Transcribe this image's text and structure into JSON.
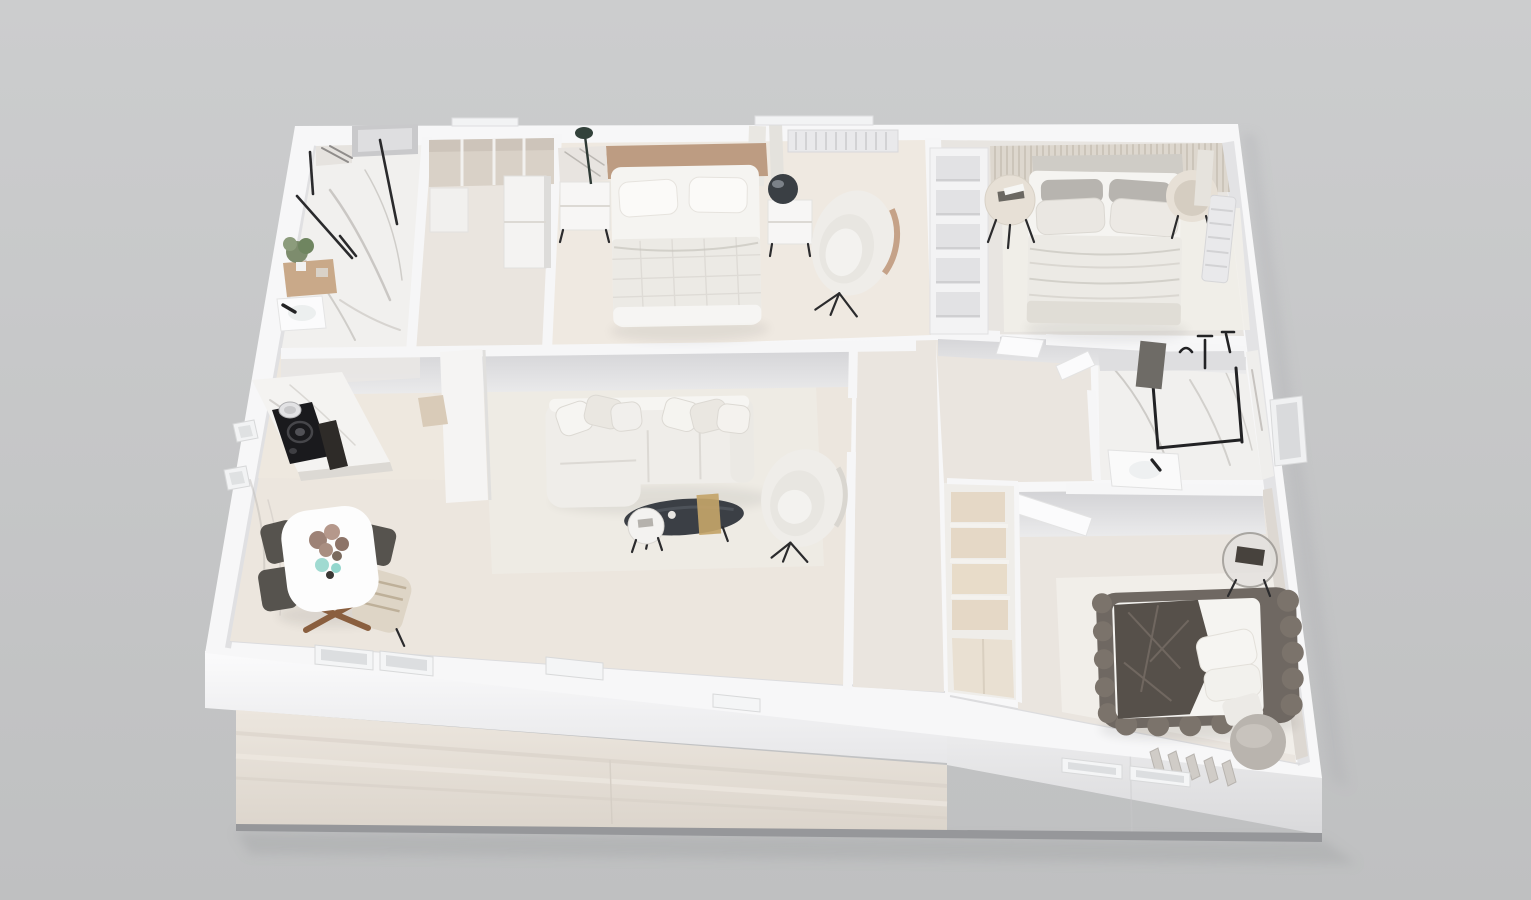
{
  "scene": {
    "type": "3d-floor-plan-render",
    "view": "axonometric top-down cutaway of a furnished apartment",
    "background": "#c7c8c9",
    "text_content": "none (image contains no rendered text)"
  },
  "palette": {
    "background": "#c7c8c9",
    "wall_top": "#f7f7f8",
    "wall_face": "#e2e2e4",
    "wall_face_dark": "#d2d2d5",
    "facade_base": "#96979a",
    "floor_wood": "#ece6de",
    "floor_wood_warm": "#efe9e1",
    "floor_pale": "#eae5df",
    "floor_grey": "#e8e5e1",
    "marble": "#f1f0ee",
    "marble_vein": "#a8a49f",
    "rug": "#f1eee9",
    "slat_wall": "#ddd7ce",
    "headboard_wood": "#bd9c82",
    "headboard_grey": "#cfccc6",
    "mattress": "#f5f4f1",
    "blanket": "#eceae5",
    "pillow_dark": "#b7b4af",
    "sofa": "#efede9",
    "coffee_table": "#3b3f45",
    "gold": "#c3a469",
    "cream_table": "#e7e0d6",
    "chair_dark": "#56534e",
    "armchair_tan": "#c09a7e",
    "bed3_frame": "#6f6862",
    "bed3_blanket": "#56504a",
    "closet_wood": "#e5d8c6",
    "cooktop": "#1a1a1d",
    "board_dark": "#2e2b28",
    "plant_green": "#7d8c6d",
    "vase_teal": "#8fd4c9",
    "flower_mauve": "#9d8276",
    "black_fixture": "#232325",
    "radiator": "#e9e9eb",
    "door_white": "#fbfbfc",
    "towel_dark": "#6e6b66",
    "table_grey": "#b9b4ae"
  },
  "rooms": [
    {
      "id": "bathroom-1",
      "name": "bathroom top-left",
      "furniture": [
        "walk-in shower with black glass frame",
        "marble floor",
        "vanity with plant and candles",
        "sink with black faucet",
        "window unit"
      ]
    },
    {
      "id": "closet-corridor",
      "name": "wardrobe corridor",
      "furniture": [
        "open wardrobe with dividers",
        "tall white cabinet"
      ]
    },
    {
      "id": "bedroom-1",
      "name": "bedroom top-middle",
      "furniture": [
        "double bed white linens",
        "wood headboard",
        "nightstand left",
        "nightstand right",
        "dark sphere lamp",
        "slim floor lamp",
        "swivel lounge chair",
        "radiator",
        "curtains"
      ]
    },
    {
      "id": "bedroom-2",
      "name": "bedroom top-right",
      "furniture": [
        "double bed layered blankets",
        "slatted headboard wall",
        "bookcase partition with cubbies",
        "round side table with books",
        "round drum side table",
        "rug",
        "vertical radiator",
        "curtain"
      ]
    },
    {
      "id": "kitchen",
      "name": "kitchen",
      "furniture": [
        "marble counter",
        "black induction cooktop",
        "pot",
        "dark cutting board",
        "tall unit column"
      ]
    },
    {
      "id": "dining",
      "name": "dining area",
      "furniture": [
        "white oval table",
        "wood cross legs",
        "dark chairs",
        "tan armchair with striped throw",
        "dried flower centerpiece",
        "teal glass vases"
      ]
    },
    {
      "id": "living-room",
      "name": "living room",
      "furniture": [
        "white sectional sofa with pillows",
        "dark oval coffee table",
        "gold table runner",
        "round white side table",
        "barrel armchair",
        "pale rug"
      ]
    },
    {
      "id": "hallway",
      "name": "hallway and lobby",
      "furniture": [
        "closet column with wood cubbies",
        "entry door sill",
        "interior door leaves"
      ]
    },
    {
      "id": "bathroom-2",
      "name": "bathroom right",
      "furniture": [
        "walk-in shower black frame",
        "black shower fixtures",
        "hanging towel",
        "white sink counter",
        "window"
      ]
    },
    {
      "id": "bedroom-3",
      "name": "bedroom bottom-right",
      "furniture": [
        "upholstered platform bed",
        "dark grey blanket",
        "white pillows",
        "glass side table",
        "round grey table",
        "ribbed radiator",
        "large pale rug",
        "white door leaf"
      ]
    }
  ]
}
